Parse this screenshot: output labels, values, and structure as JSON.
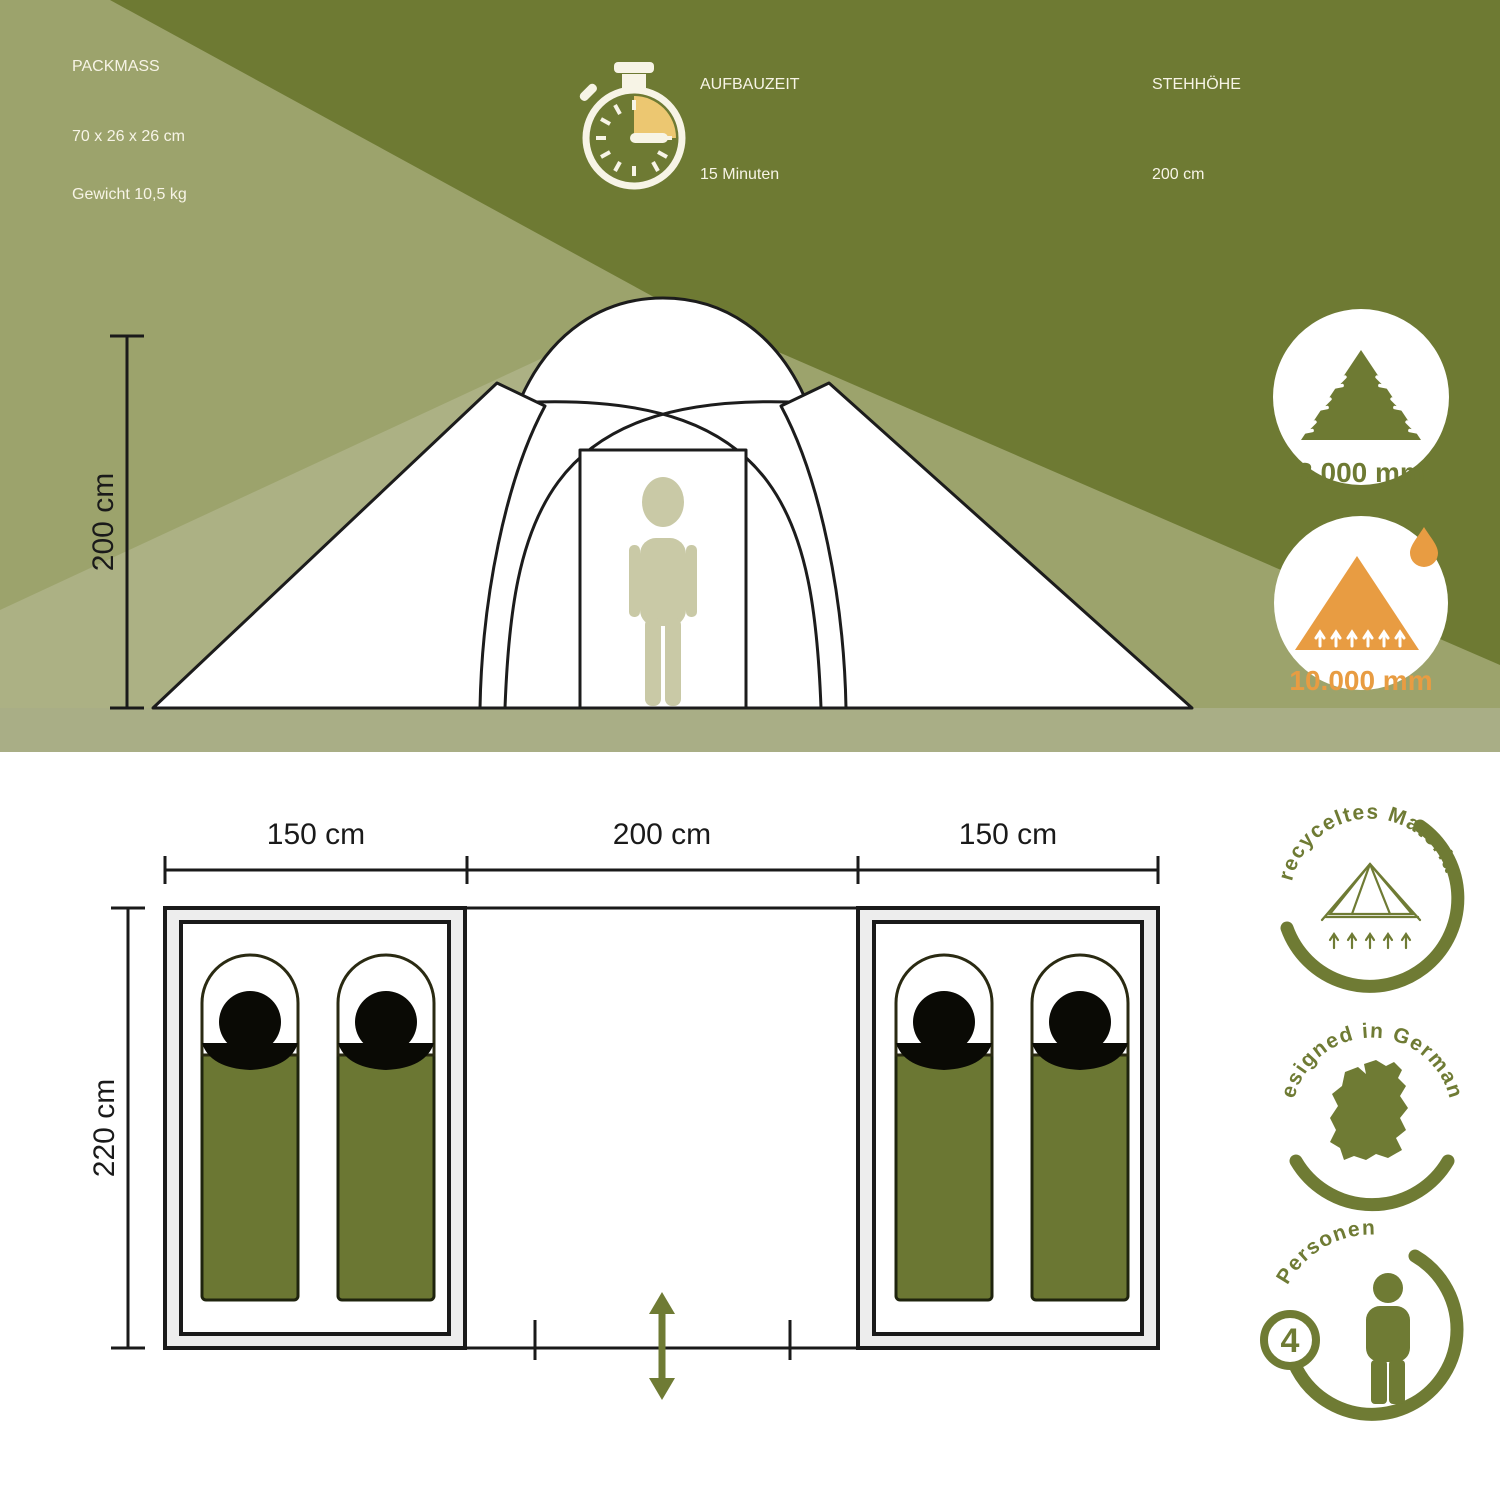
{
  "header": {
    "packmass": {
      "title": "PACKMASS",
      "dimensions": "70 x 26 x 26 cm",
      "weight": "Gewicht 10,5 kg"
    },
    "aufbauzeit": {
      "title": "AUFBAUZEIT",
      "value": "15 Minuten"
    },
    "stehhoehe": {
      "title": "STEHHÖHE",
      "value": "200 cm"
    }
  },
  "elevation": {
    "height_label": "200 cm",
    "water_badge_outer": "3.000 mm",
    "water_badge_floor": "10.000 mm"
  },
  "floorplan": {
    "widths": [
      "150 cm",
      "200 cm",
      "150 cm"
    ],
    "depth_label": "220 cm"
  },
  "seals": {
    "material": "recyceltes Material",
    "design": "designed in Germany",
    "persons_word": "Personen",
    "persons_count": "4"
  },
  "colors": {
    "olive_dark": "#6E7A33",
    "olive_light": "#9CA36C",
    "olive_lighter": "#ACB184",
    "ground": "#A9AE86",
    "cream": "#F7F4E6",
    "ink": "#1A1A1A",
    "bag_green": "#6B7733",
    "silhouette": "#C9C9A6",
    "accent_orange": "#E89C42",
    "stopwatch_yellow": "#ECC771",
    "badge_olive": "#6F7B34"
  }
}
